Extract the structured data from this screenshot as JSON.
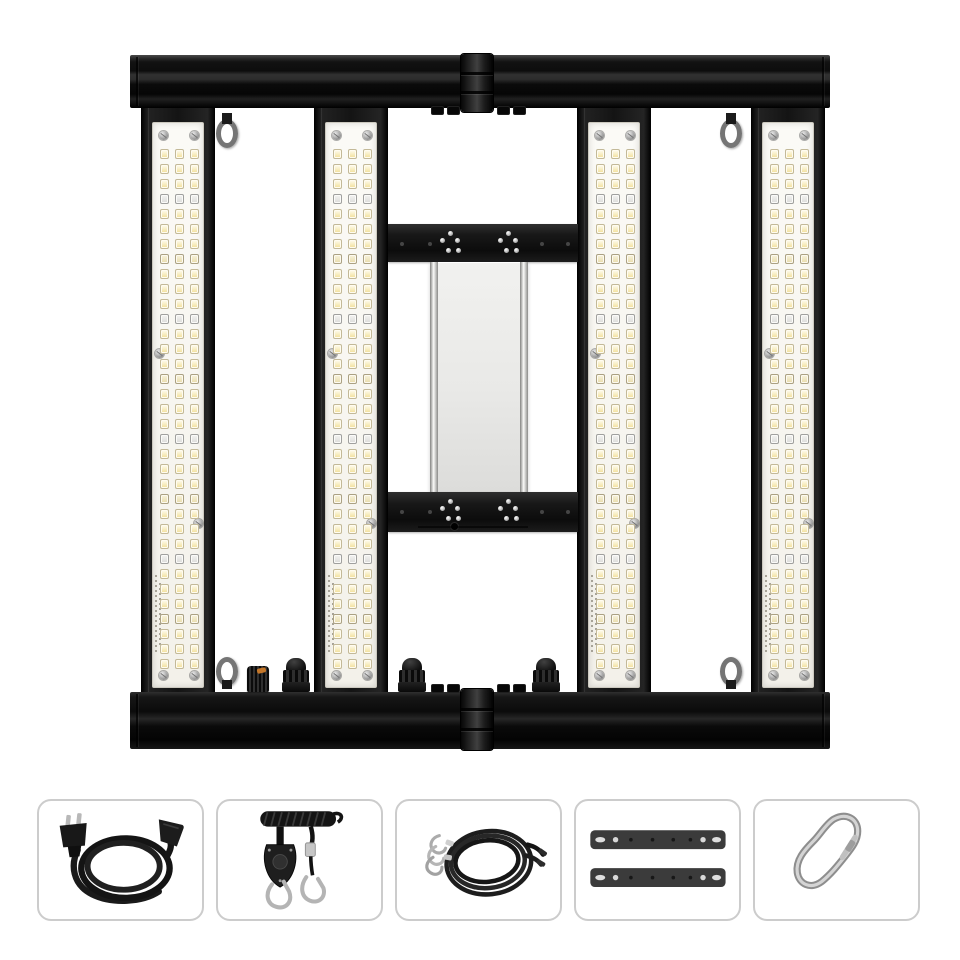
{
  "image": {
    "kind": "product-photo",
    "subject": "foldable-4-bar-led-grow-light",
    "background": "#ffffff"
  },
  "fixture": {
    "bar_count": 4,
    "led_columns": 3,
    "led_rows": 35,
    "special_row_period": 8,
    "special_row_index": 3,
    "mixed_row_index": 7,
    "colors": {
      "rail_black": "#101010",
      "bar_frame": "#161616",
      "board_white": "#f7f5f0",
      "led_warm": "#f2e09c",
      "led_special": "#e2e2e0",
      "driver_gray": "#ebebe9",
      "knob_accent": "#c4772a",
      "metal_silver": "#b2b2b2"
    }
  },
  "accessories": [
    {
      "id": "power-cord",
      "icon": "power-cord-icon"
    },
    {
      "id": "rope-ratchet-hangers",
      "icon": "rope-ratchet-icon"
    },
    {
      "id": "steel-cable-hangers",
      "icon": "steel-cable-icon"
    },
    {
      "id": "mounting-brackets",
      "icon": "mounting-bracket-icon"
    },
    {
      "id": "carabiner-clip",
      "icon": "carabiner-icon"
    }
  ]
}
